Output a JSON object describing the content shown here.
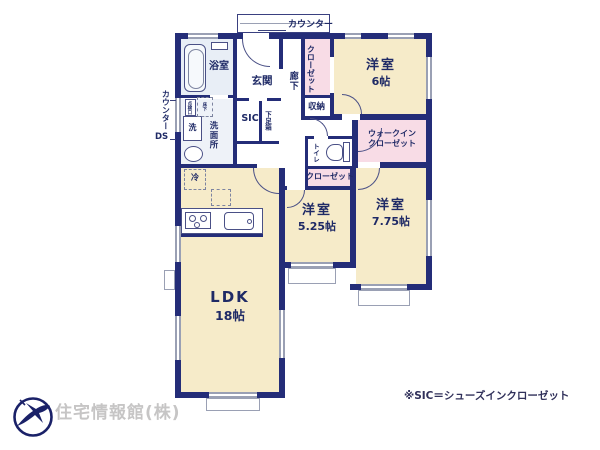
{
  "colors": {
    "wall": "#242d78",
    "room_beige": "#f6ebc9",
    "closet_pink": "#f8dce6",
    "wet_blue": "#e8eef6",
    "wet_blue_light": "#eef2f8",
    "label_navy": "#1f2a66",
    "window_gray": "#9aa0b4",
    "logo_navy": "#1a2168",
    "company_gray": "#c6c5c5",
    "note_navy": "#30305a"
  },
  "plan": {
    "rooms": {
      "bath": {
        "label": "浴室"
      },
      "washroom": {
        "label": "洗面所"
      },
      "genkan": {
        "label": "玄関"
      },
      "hallway": {
        "label": "廊下"
      },
      "closet_north": {
        "label": "クローゼット"
      },
      "room_6": {
        "name": "洋室",
        "size": "6帖"
      },
      "storage": {
        "label": "収納"
      },
      "sic": {
        "label": "SIC"
      },
      "shoe_box": {
        "label": "下足箱"
      },
      "toilet": {
        "label": "トイレ"
      },
      "wic": {
        "line1": "ウォークイン",
        "line2": "クローゼット"
      },
      "closet_mid": {
        "label": "クローゼット"
      },
      "room_525": {
        "name": "洋室",
        "size": "5.25帖"
      },
      "room_775": {
        "name": "洋室",
        "size": "7.75帖"
      },
      "ldk": {
        "name": "LDK",
        "size": "18帖"
      }
    },
    "fixtures": {
      "washer": {
        "label": "洗"
      },
      "fridge": {
        "label": "冷"
      },
      "floor_hatch": {
        "label_inner": "点検口",
        "label_outer": "床下"
      }
    },
    "annotations": {
      "counter_top": {
        "label": "カウンター"
      },
      "counter_left": {
        "label": "カウンター"
      },
      "duct_space": {
        "label": "DS"
      }
    }
  },
  "footer": {
    "company": "住宅情報館(株)",
    "note": "※SIC＝シューズインクローゼット"
  }
}
